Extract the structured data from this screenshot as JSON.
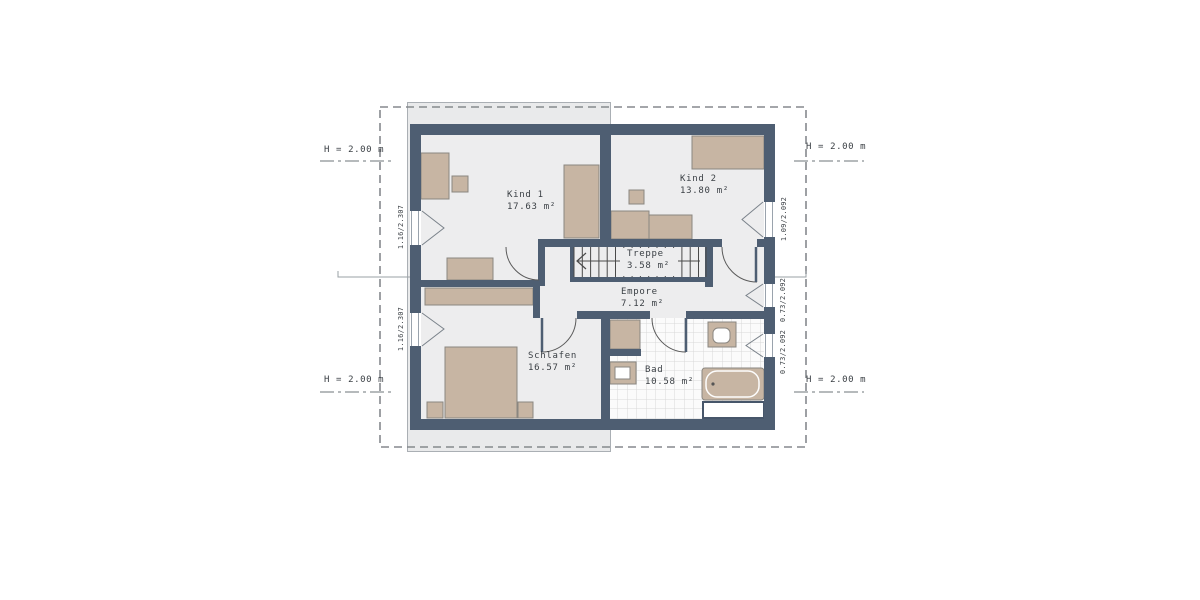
{
  "plan": {
    "rooms": [
      {
        "name": "Kind 1",
        "area": "17.63 m²"
      },
      {
        "name": "Kind 2",
        "area": "13.80 m²"
      },
      {
        "name": "Treppe",
        "area": "3.58 m²"
      },
      {
        "name": "Empore",
        "area": "7.12 m²"
      },
      {
        "name": "Schlafen",
        "area": "16.57 m²"
      },
      {
        "name": "Bad",
        "area": "10.58 m²"
      }
    ],
    "height_marks": {
      "top_left": "H = 2.00 m",
      "top_right": "H = 2.00 m",
      "bottom_left": "H = 2.00 m",
      "bottom_right": "H = 2.00 m"
    },
    "window_marks": {
      "left_upper": "1.16/2.307",
      "left_lower": "1.16/2.307",
      "right_upper": "1.09/2.092",
      "right_middle": "0.73/2.092",
      "right_lower": "0.73/2.092"
    },
    "colors": {
      "wall": "#4e5e72",
      "furniture": "#c7b5a3",
      "floor": "#ededee",
      "band": "#e9eaeb",
      "tile-line": "#d8d8d8"
    }
  }
}
